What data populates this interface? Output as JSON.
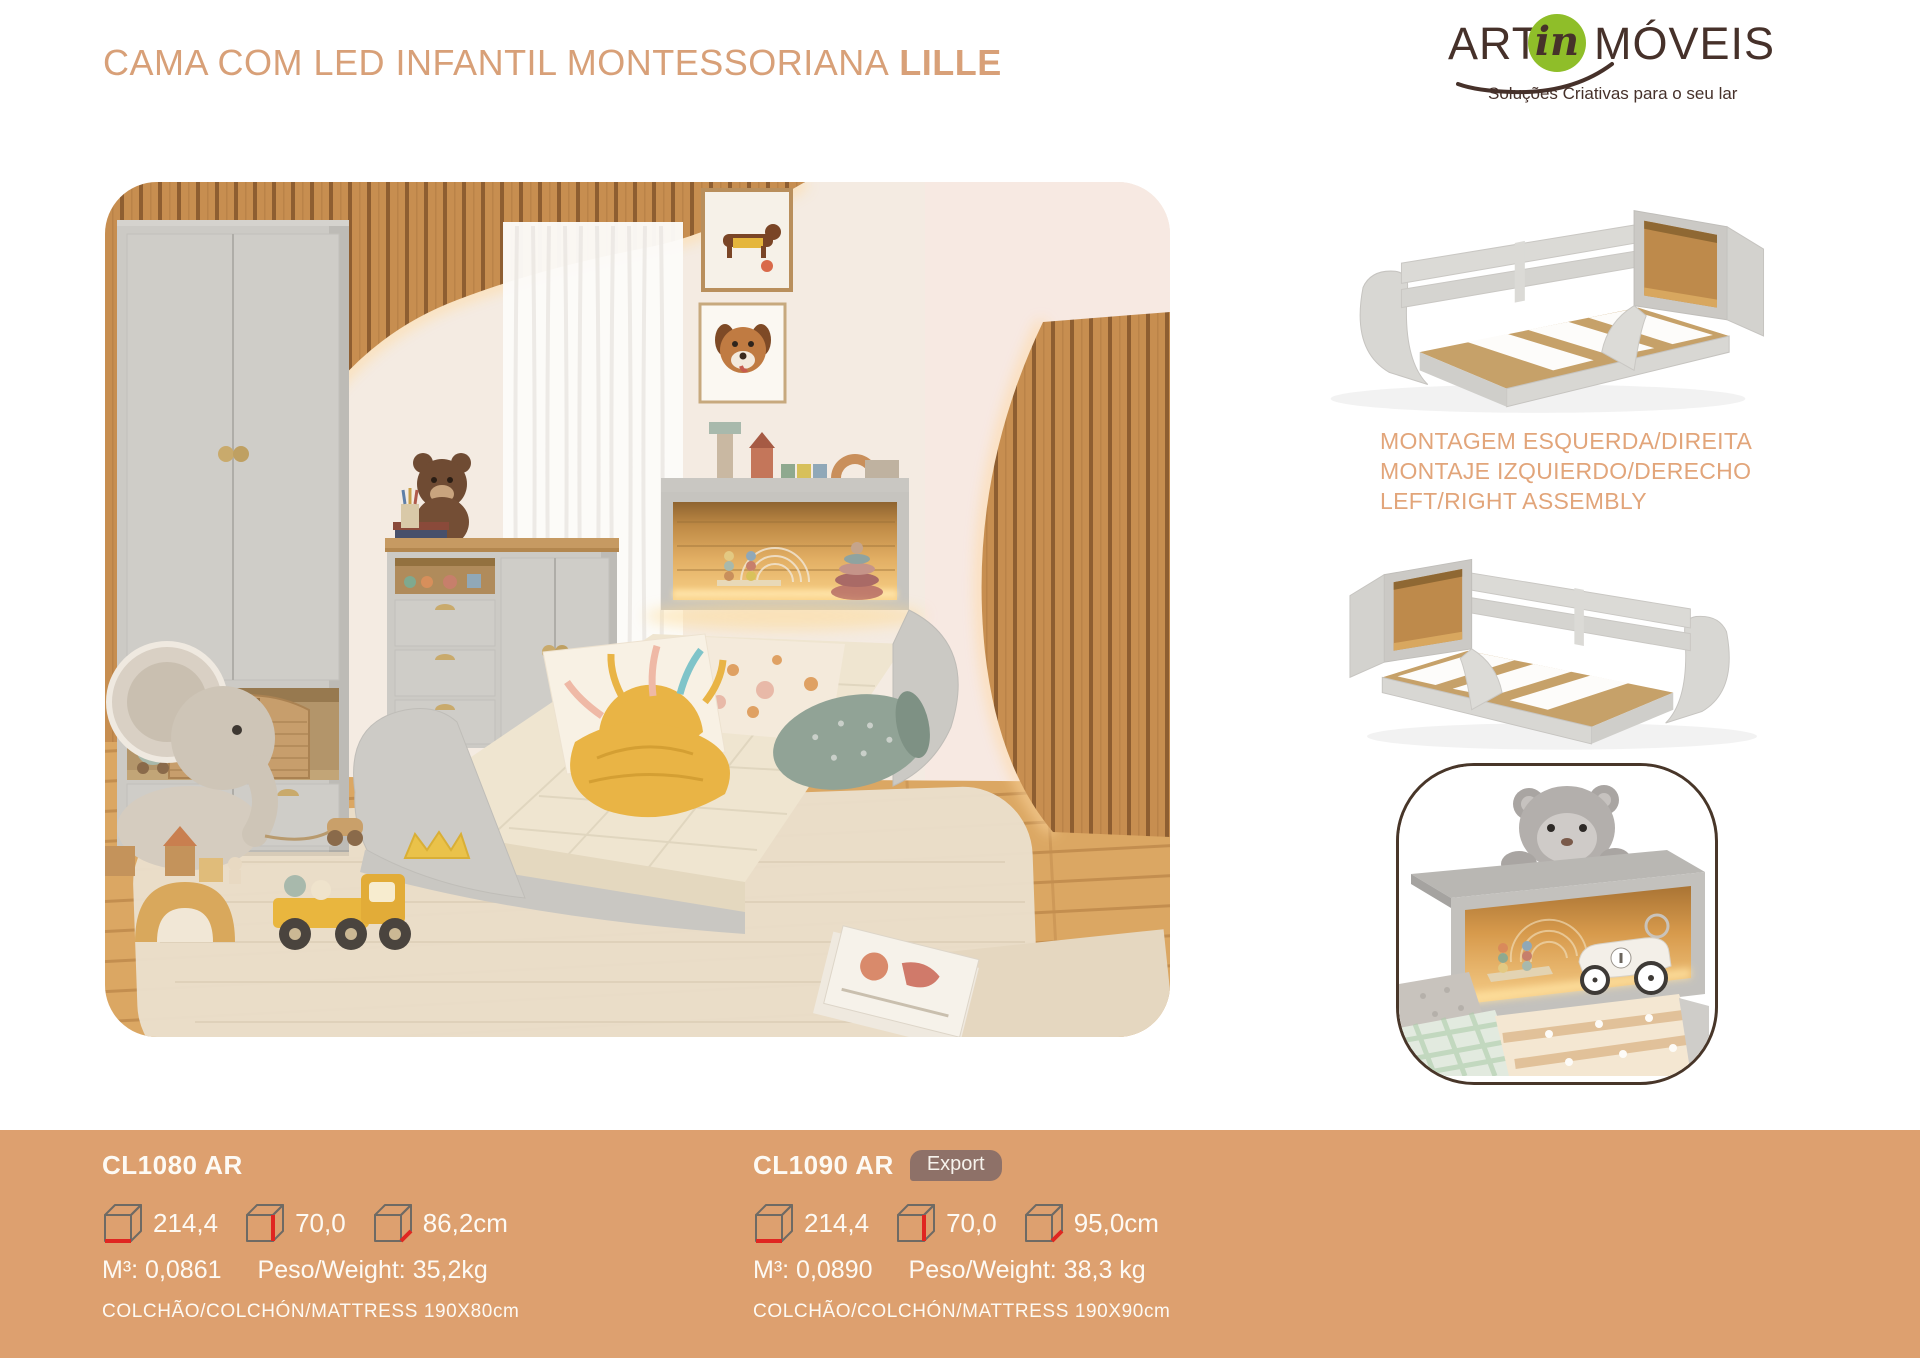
{
  "header": {
    "title_main": "CAMA COM LED INFANTIL MONTESSORIANA",
    "title_model": "LILLE"
  },
  "brand": {
    "name_left": "ART",
    "name_script": "in",
    "name_right": "MÓVEIS",
    "tagline": "Soluções Criativas para o seu lar"
  },
  "assembly_note": {
    "pt": "MONTAGEM ESQUERDA/DIREITA",
    "es": "MONTAJE IZQUIERDO/DERECHO",
    "en": "LEFT/RIGHT ASSEMBLY"
  },
  "products": [
    {
      "code": "CL1080 AR",
      "dim_width": "214,4",
      "dim_height": "70,0",
      "dim_depth": "86,2cm",
      "volume": "M³: 0,0861",
      "weight": "Peso/Weight: 35,2kg",
      "mattress": "COLCHÃO/COLCHÓN/MATTRESS 190X80cm"
    },
    {
      "code": "CL1090 AR",
      "badge": "Export",
      "dim_width": "214,4",
      "dim_height": "70,0",
      "dim_depth": "95,0cm",
      "volume": "M³: 0,0890",
      "weight": "Peso/Weight: 38,3 kg",
      "mattress": "COLCHÃO/COLCHÓN/MATTRESS 190X90cm"
    }
  ],
  "colors": {
    "accent_bar": "#DDA06F",
    "title_text": "#D8A078",
    "assembly_text": "#E2A57A",
    "brand_brown": "#46312A",
    "brand_green": "#8FBE29",
    "dimension_red": "#E02621",
    "badge_bg": "#8E7168"
  }
}
